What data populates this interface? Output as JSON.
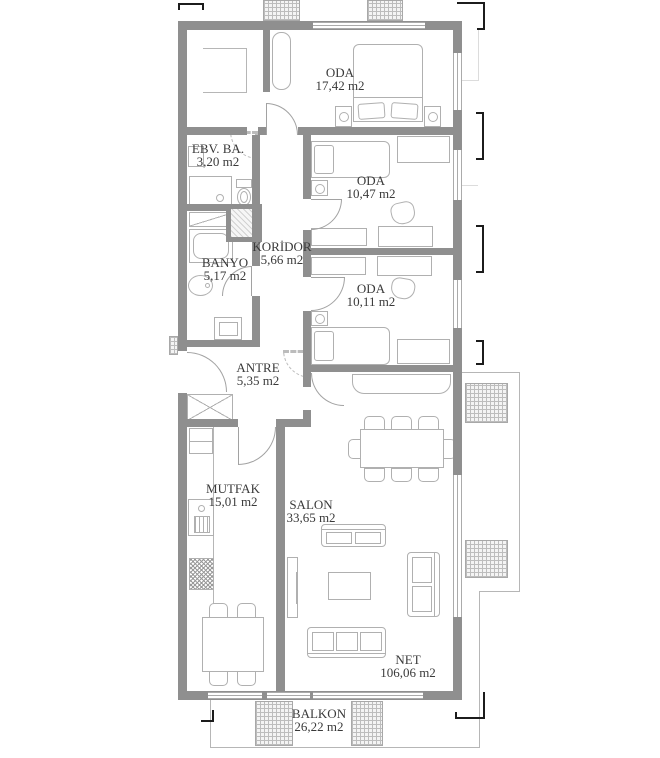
{
  "plan": {
    "rooms": [
      {
        "name": "ODA",
        "area": "17,42 m2"
      },
      {
        "name": "EBV. BA.",
        "area": "3,20 m2"
      },
      {
        "name": "ODA",
        "area": "10,47 m2"
      },
      {
        "name": "KORİDOR",
        "area": "5,66 m2"
      },
      {
        "name": "BANYO",
        "area": "5,17 m2"
      },
      {
        "name": "ODA",
        "area": "10,11 m2"
      },
      {
        "name": "ANTRE",
        "area": "5,35 m2"
      },
      {
        "name": "MUTFAK",
        "area": "15,01 m2"
      },
      {
        "name": "SALON",
        "area": "33,65 m2"
      }
    ],
    "balcony": {
      "name": "BALKON",
      "area": "26,22 m2"
    },
    "net": {
      "label": "NET",
      "area": "106,06 m2"
    },
    "colors": {
      "wall": "#8f8f8f",
      "furniture_line": "#b0b0b0",
      "text": "#3a3a3a",
      "dimension": "#1c1c1c",
      "hatch_bg": "#f4f4f4"
    }
  }
}
